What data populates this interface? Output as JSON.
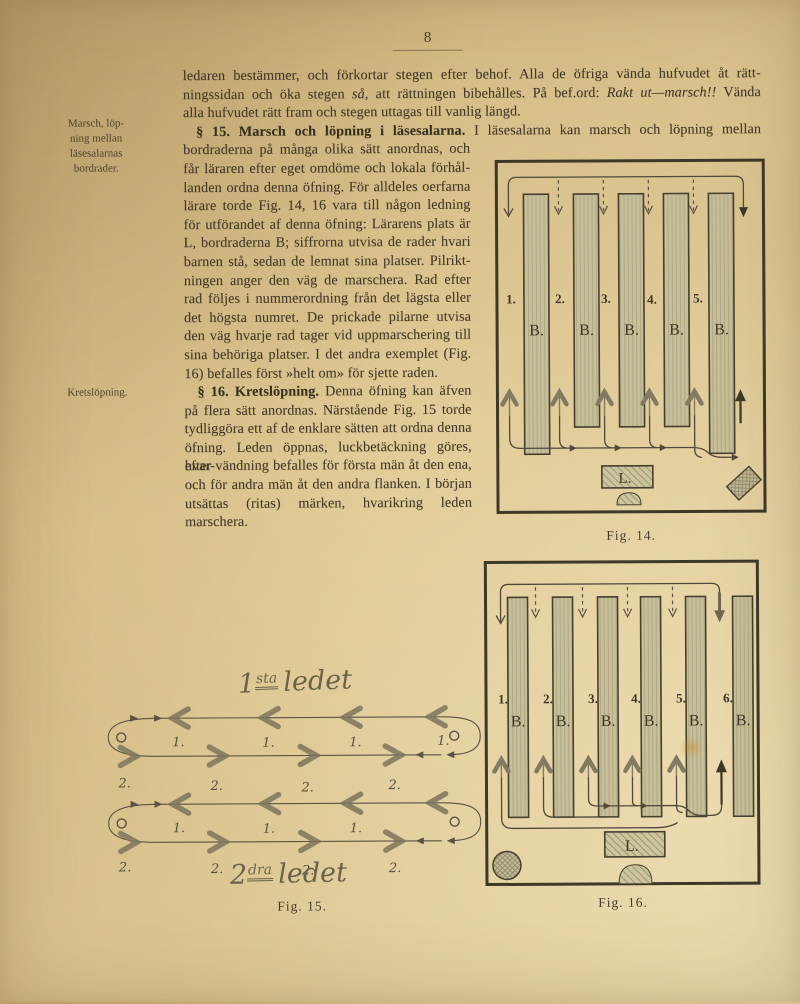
{
  "page": {
    "number": "8"
  },
  "margin_notes": {
    "note1_lines": [
      "Marsch, löp-",
      "ning mellan",
      "läsesalarnas",
      "bordrader."
    ],
    "note2": "Kretslöpning."
  },
  "body": {
    "l01": "ledaren bestämmer, och förkortar stegen efter behof.  Alla de öfriga vända hufvudet åt rätt-",
    "l02a": "ningssidan och öka stegen ",
    "l02b": "så",
    "l02c": ", att rättningen bibehålles.  På bef.ord: ",
    "l02d": "Rakt ut—marsch!!",
    "l02e": " Vända",
    "l03": "alla hufvudet rätt fram och stegen uttagas till vanlig längd.",
    "l04a": "§ 15.  Marsch och löpning i läsesalarna.",
    "l04b": " I läsesalarna kan marsch och löpning mellan",
    "l05": "bordraderna på många olika sätt anordnas, och",
    "l06": "får läraren efter eget omdöme och lokala förhål-",
    "l07": "landen ordna denna öfning.  För alldeles oerfarna",
    "l08": "lärare torde Fig. 14, 16 vara till någon ledning",
    "l09": "för utförandet af denna öfning:  Lärarens plats är",
    "l10": "L, bordraderna B; siffrorna utvisa de rader hvari",
    "l11": "barnen stå, sedan de lemnat sina platser.  Pilrikt-",
    "l12": "ningen anger den väg de marschera.  Rad efter",
    "l13": "rad följes i nummerordning från det lägsta eller",
    "l14": "det högsta numret.  De prickade pilarne utvisa",
    "l15": "den väg hvarje rad tager vid uppmarschering till",
    "l16": "sina behöriga platser.  I det andra exemplet (Fig.",
    "l17": "16) befalles först »helt om» för sjette raden.",
    "l18a": "§ 16.  Kretslöpning.",
    "l18b": " Denna öfning kan äfven",
    "l19": "på flera sätt anordnas.  Närstående Fig. 15 torde",
    "l20": "tydliggöra ett af de enklare sätten att ordna denna",
    "l21": "öfning.  Leden öppnas, luckbetäckning göres, hvar-",
    "l22": "efter vändning befalles för första män åt den ena,",
    "l23": "och för andra män åt den andra flanken.  I början",
    "l24": "utsättas (ritas) märken, hvarikring leden marschera."
  },
  "fig14": {
    "numbers": [
      "1.",
      "2.",
      "3.",
      "4.",
      "5."
    ],
    "desk_label": "B.",
    "teacher_label": "L.",
    "caption": "Fig. 14."
  },
  "fig15": {
    "rank1_title": {
      "num": "1",
      "sup": "sta",
      "word": "ledet"
    },
    "rank2_title": {
      "num": "2",
      "sup": "dra",
      "word": "ledet"
    },
    "marker1": "1.",
    "marker2": "2.",
    "caption": "Fig. 15."
  },
  "fig16": {
    "numbers": [
      "1.",
      "2.",
      "3.",
      "4.",
      "5.",
      "6."
    ],
    "desk_label": "B.",
    "teacher_label": "L.",
    "caption": "Fig. 16."
  }
}
